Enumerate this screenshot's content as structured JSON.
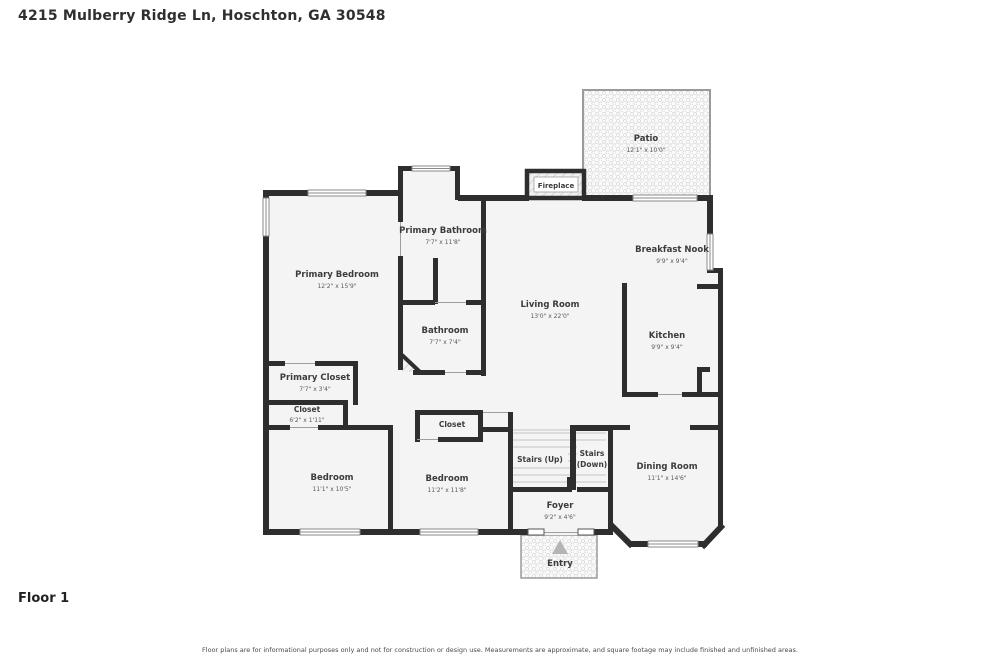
{
  "page": {
    "title": "4215 Mulberry Ridge Ln, Hoschton, GA 30548",
    "floor_label": "Floor 1",
    "disclaimer": "Floor plans are for informational purposes only and not for construction or design use. Measurements are approximate, and square footage may include finished and unfinished areas."
  },
  "colors": {
    "wall": "#2e2e2e",
    "floor_fill": "#f4f4f4",
    "hatch_line": "#d6d6d6",
    "window_line": "#8a8a8a",
    "text": "#3c3c3c"
  },
  "rooms": {
    "patio": {
      "name": "Patio",
      "dims": "12'1\" x 10'0\""
    },
    "fireplace": {
      "name": "Fireplace"
    },
    "primary_bathroom": {
      "name": "Primary Bathroom",
      "dims": "7'7\" x 11'8\""
    },
    "breakfast_nook": {
      "name": "Breakfast Nook",
      "dims": "9'9\" x 9'4\""
    },
    "primary_bedroom": {
      "name": "Primary Bedroom",
      "dims": "12'2\" x 15'9\""
    },
    "living_room": {
      "name": "Living Room",
      "dims": "13'0\" x 22'0\""
    },
    "kitchen": {
      "name": "Kitchen",
      "dims": "9'9\" x 9'4\""
    },
    "bathroom": {
      "name": "Bathroom",
      "dims": "7'7\" x 7'4\""
    },
    "primary_closet": {
      "name": "Primary Closet",
      "dims": "7'7\" x 3'4\""
    },
    "closet_a": {
      "name": "Closet",
      "dims": "6'2\" x 1'11\""
    },
    "closet_b": {
      "name": "Closet"
    },
    "stairs_up": {
      "name": "Stairs (Up)"
    },
    "stairs_down": {
      "name": "Stairs",
      "dims": "(Down)"
    },
    "dining_room": {
      "name": "Dining Room",
      "dims": "11'1\" x 14'6\""
    },
    "bedroom_a": {
      "name": "Bedroom",
      "dims": "11'1\" x 10'5\""
    },
    "bedroom_b": {
      "name": "Bedroom",
      "dims": "11'2\" x 11'8\""
    },
    "foyer": {
      "name": "Foyer",
      "dims": "9'2\" x 4'6\""
    },
    "entry": {
      "name": "Entry"
    }
  }
}
